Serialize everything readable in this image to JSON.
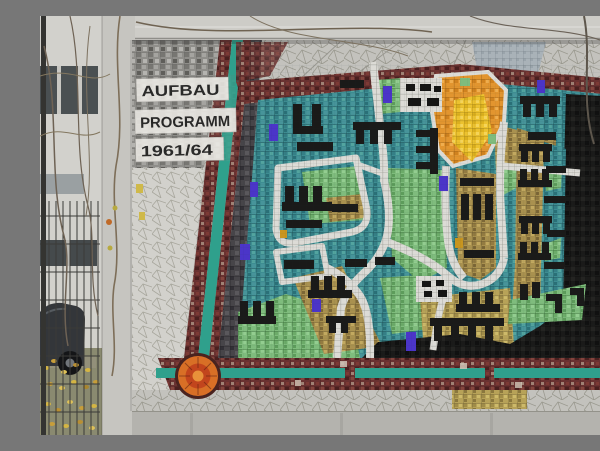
{
  "scene": {
    "type": "outdoor-photograph",
    "subject": "Wall mosaic of a town development plan (Aufbauprogramm 1961/64) set in a concrete frame; building facade, wire fence, parked car and autumn leaves at left",
    "sign": {
      "line1": "AUFBAU",
      "line2": "PROGRAMM",
      "line3": "1961/64"
    },
    "palette": {
      "concrete": "#c6c5c0",
      "facade": "#d2d1cc",
      "pavement_gray": "#c3c2bd",
      "granite_gray": "#8f8e8a",
      "maroon_band": "#6a3231",
      "teal_stripe": "#2fa08c",
      "map_teal": "#3e8d92",
      "park_green": "#7fbc7d",
      "district_tan": "#a9914f",
      "district_gold": "#b7a258",
      "district_orange": "#e2952f",
      "district_yellow": "#ecc22f",
      "building_black": "#1a1a19",
      "road_white": "#dcdbd6",
      "accent_purple": "#4b35c8",
      "circle_orange": "#d86f26",
      "autumn_leaf": "#d4b544"
    }
  }
}
